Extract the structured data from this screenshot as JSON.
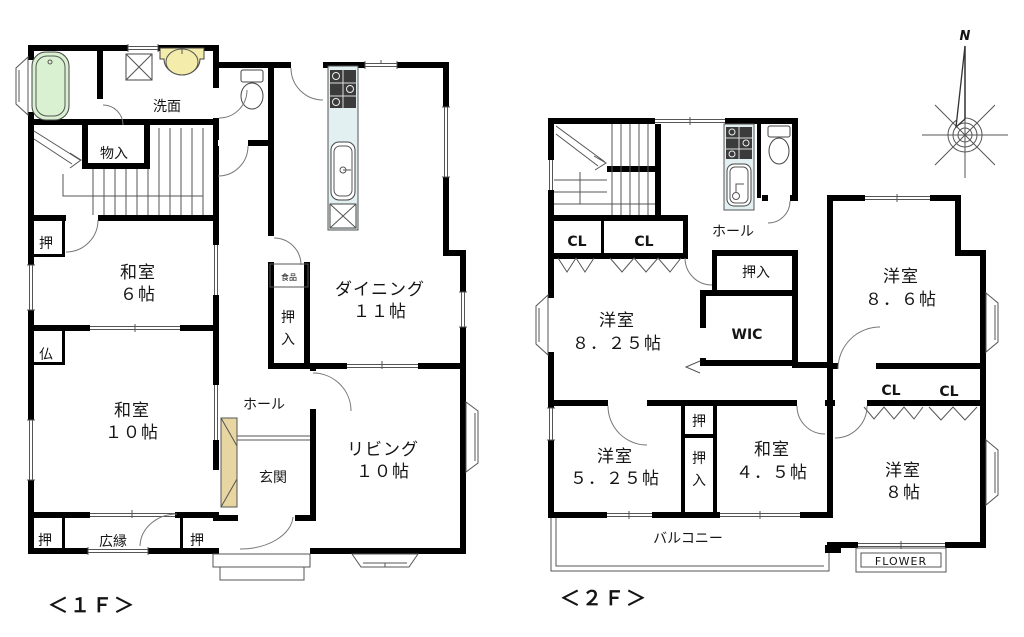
{
  "colors": {
    "tub": "#d9f1d1",
    "basin": "#f3ecab",
    "counter": "#e3f0f1",
    "cabinet": "#e8d6a2",
    "stove": "#3b3b3b"
  },
  "floor1": {
    "caption": "＜１Ｆ＞",
    "senmen": "洗面",
    "monoiri": "物入",
    "oshi_upper": "押",
    "washitsu6_name": "和室",
    "washitsu6_size": "６帖",
    "butsudan": "仏",
    "washitsu10_name": "和室",
    "washitsu10_size": "１０帖",
    "oshi_left": "押",
    "hiroen": "広縁",
    "oshi_right": "押",
    "hall": "ホール",
    "genkan": "玄関",
    "living_name": "リビング",
    "living_size": "１０帖",
    "dining_name": "ダイニング",
    "dining_size": "１１帖",
    "oshiire_c1": "押",
    "oshiire_c2": "入",
    "pantry": "食品"
  },
  "floor2": {
    "caption": "＜２Ｆ＞",
    "cl_a": "CL",
    "cl_b": "CL",
    "hall": "ホール",
    "oshiire": "押入",
    "y825_name": "洋室",
    "y825_size": "８．２５帖",
    "wic": "WIC",
    "y86_name": "洋室",
    "y86_size": "８．６帖",
    "cl_c": "CL",
    "cl_d": "CL",
    "y525_name": "洋室",
    "y525_size": "５．２５帖",
    "oshi_small": "押",
    "oshiire_v1": "押",
    "oshiire_v2": "入",
    "w45_name": "和室",
    "w45_size": "４．５帖",
    "y8_name": "洋室",
    "y8_size": "８帖",
    "balcony": "バルコニー",
    "flower": "FLOWER"
  },
  "compass": {
    "north": "N"
  }
}
